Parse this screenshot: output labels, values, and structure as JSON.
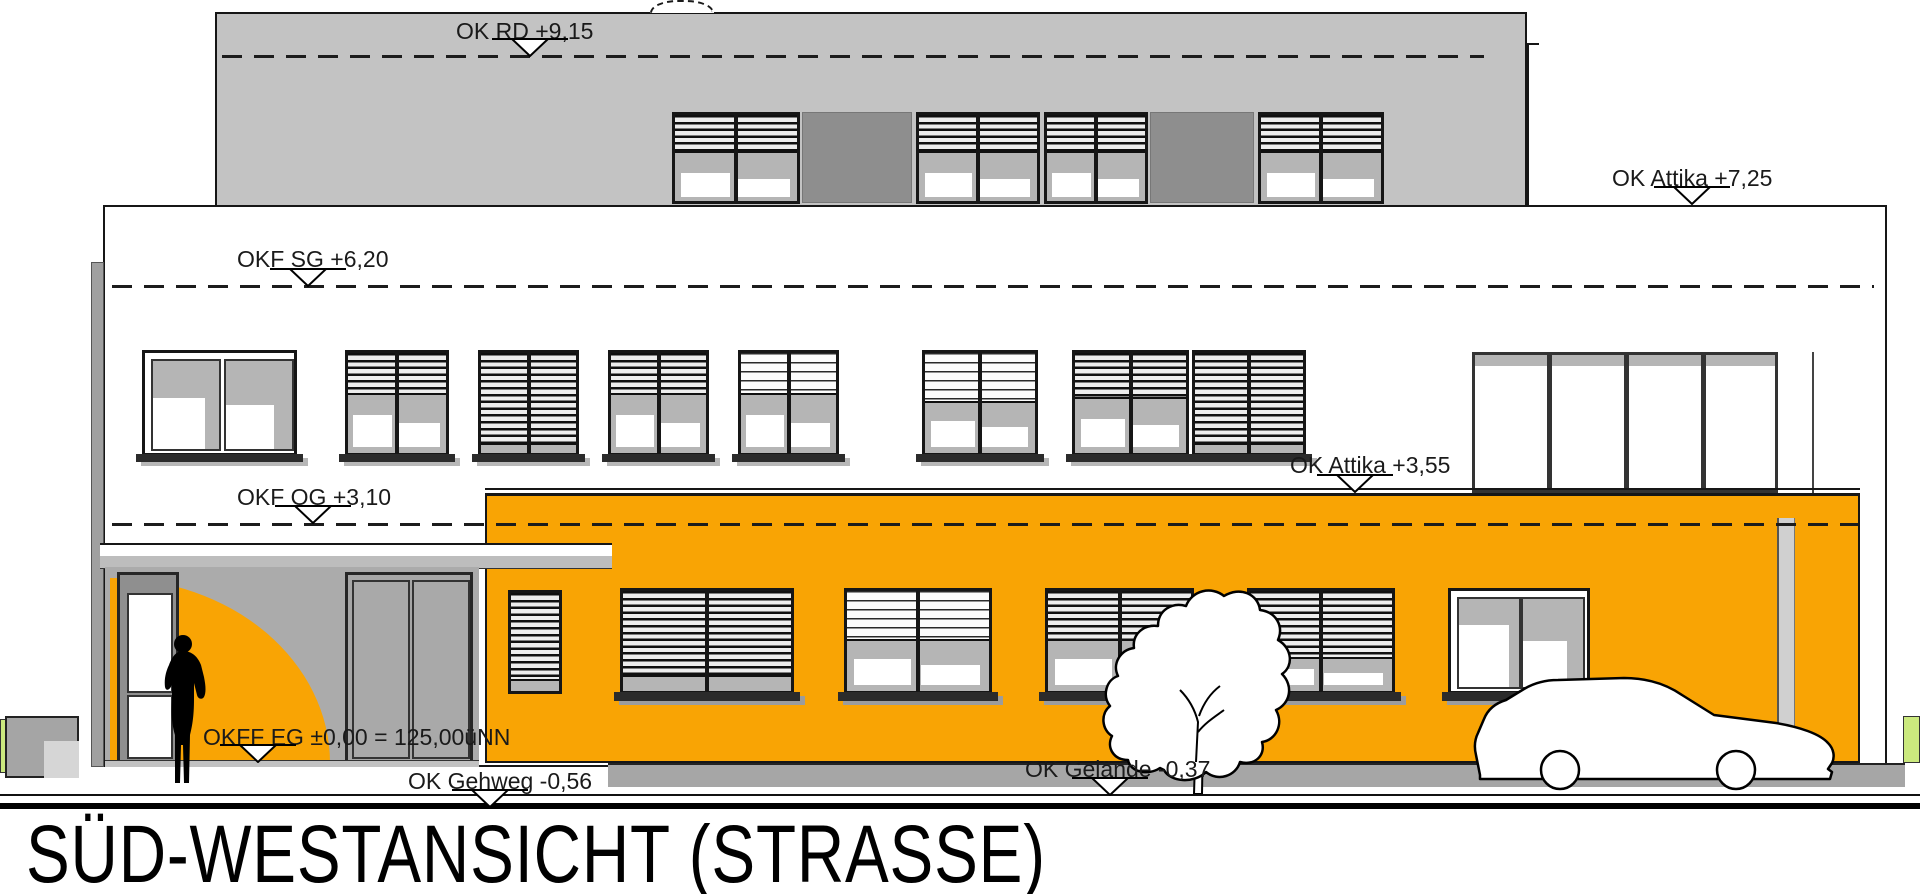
{
  "drawing": {
    "title": "SÜD-WESTANSICHT (STRASSE)",
    "levels": {
      "ok_rd": "OK RD +9,15",
      "ok_attika_upper": "OK Attika +7,25",
      "okf_sg": "OKF SG +6,20",
      "ok_attika_lower": "OK Attika +3,55",
      "okf_og": "OKF OG +3,10",
      "okff_eg": "OKFF EG ±0,00 = 125,00üNN",
      "ok_gehweg": "OK Gehweg -0,56",
      "ok_gelaende": "OK Gelände -0,37"
    },
    "colors": {
      "facade_orange": "#F9A404",
      "upper_floor_gray": "#C3C3C3",
      "panel_dark_gray": "#8E8E8E",
      "glass_gray": "#B5B5B5",
      "recess_gray": "#ABABAB",
      "terrain_gray": "#A6A6A6",
      "grass_green": "#CBE97E",
      "line_black": "#161616"
    }
  }
}
